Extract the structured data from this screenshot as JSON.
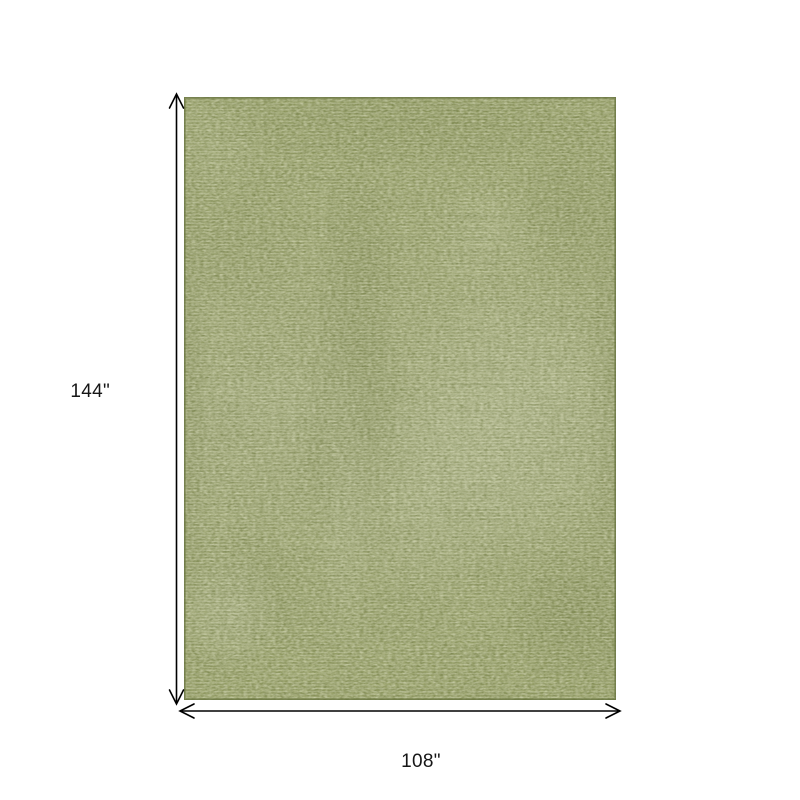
{
  "diagram": {
    "height_label": "144\"",
    "width_label": "108\"",
    "dimension_line_color": "#000000",
    "background_color": "#ffffff",
    "rug": {
      "base_color": "#abb37e",
      "light_patch_color": "#cbd0ab",
      "dark_patch_color": "#78824b",
      "border_color": "#6e7a43",
      "speckle_dark_color": "#6f7a45",
      "speckle_light_color": "#dde0c2"
    },
    "icons": {
      "height_arrow": "vertical-double-headed-arrow",
      "width_arrow": "horizontal-double-headed-arrow"
    }
  }
}
